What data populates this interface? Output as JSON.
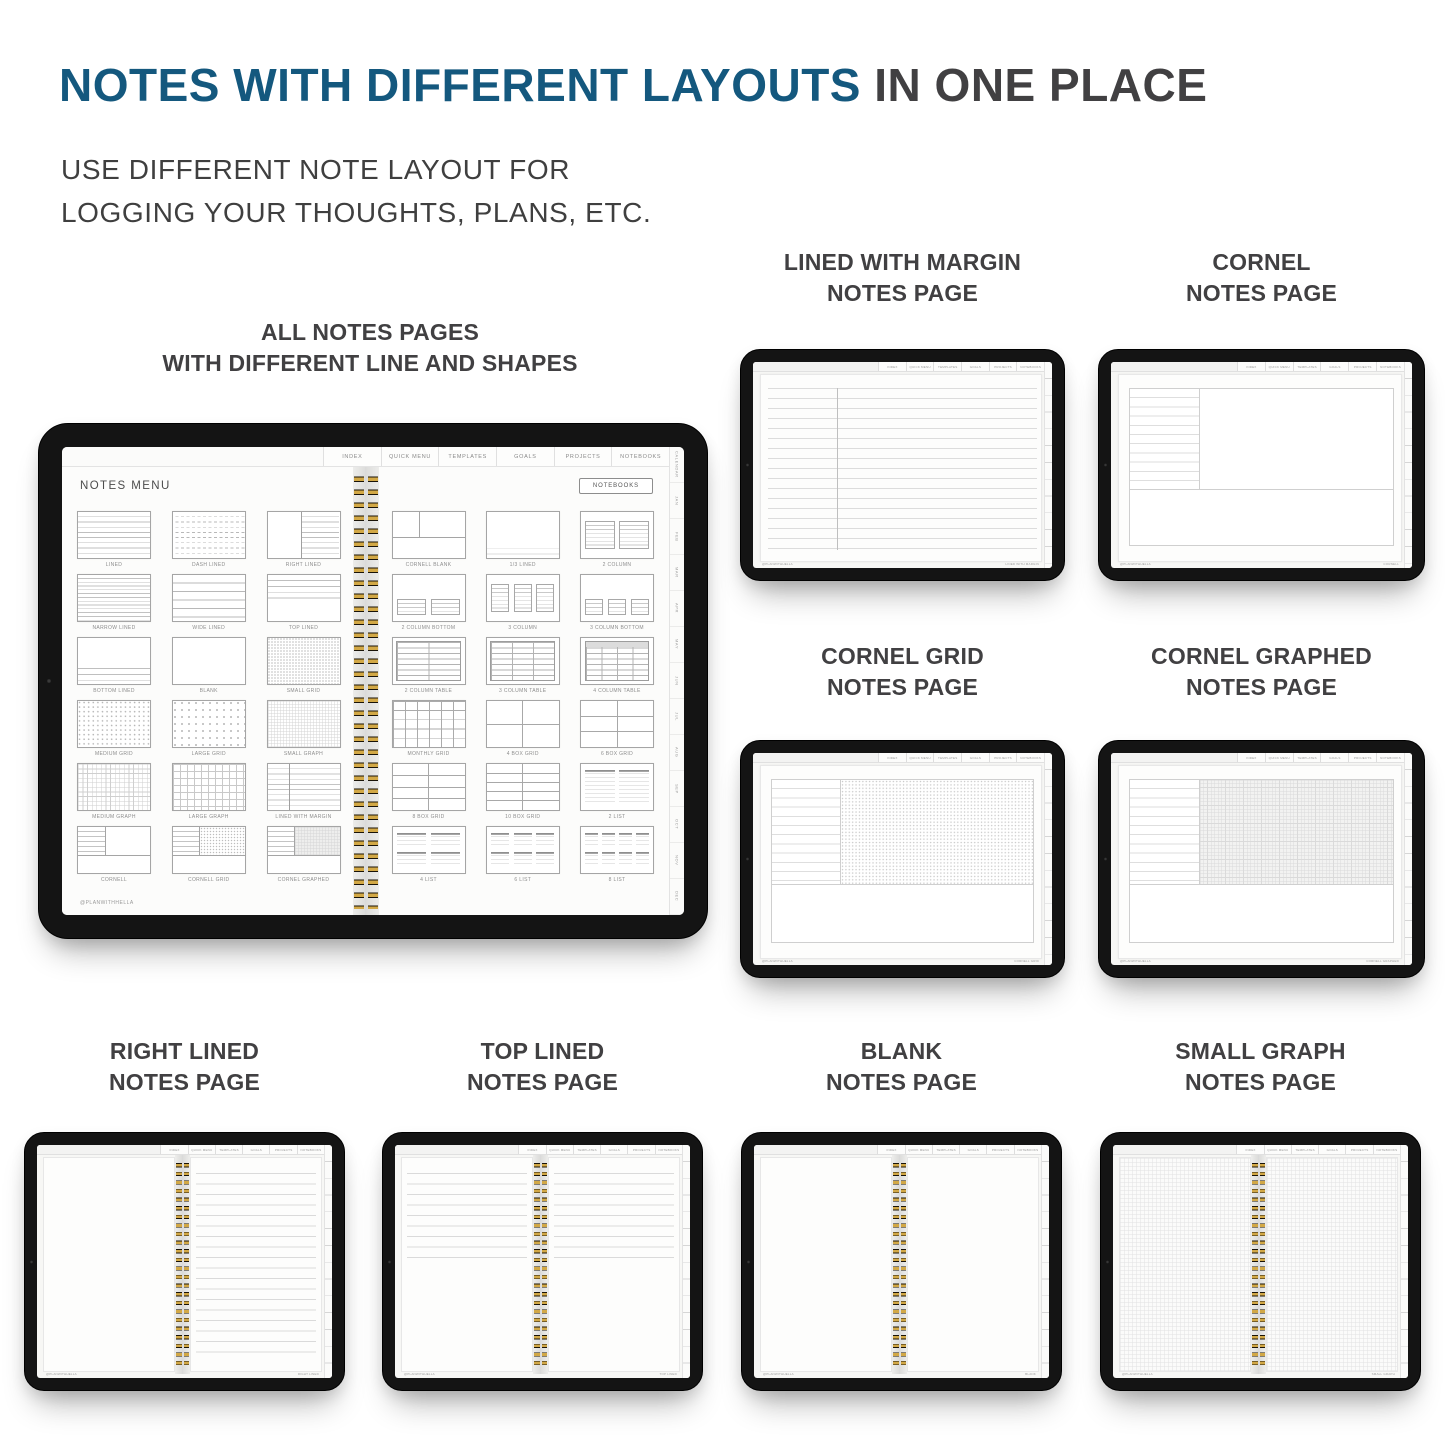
{
  "page": {
    "title_highlight": "NOTES WITH DIFFERENT LAYOUTS",
    "title_rest": " IN ONE PLACE",
    "subtitle_line1": "USE DIFFERENT NOTE LAYOUT FOR",
    "subtitle_line2": "LOGGING YOUR THOUGHTS, PLANS, ETC.",
    "colors": {
      "accent_blue": "#14587E",
      "heading_gray": "#414042",
      "spiral_gold": "#D2A846"
    }
  },
  "main_tablet": {
    "caption_line1": "ALL NOTES PAGES",
    "caption_line2": "WITH DIFFERENT LINE AND SHAPES",
    "screen": {
      "tabs": [
        "INDEX",
        "QUICK MENU",
        "TEMPLATES",
        "GOALS",
        "PROJECTS",
        "NOTEBOOKS"
      ],
      "side_tabs": [
        "CALENDAR",
        "JAN",
        "FEB",
        "MAR",
        "APR",
        "MAY",
        "JUN",
        "JUL",
        "AUG",
        "SEP",
        "OCT",
        "NOV",
        "DEC"
      ],
      "notes_menu_title": "NOTES MENU",
      "notebooks_button": "NOTEBOOKS",
      "footer_handle": "@PLANWITHHELLA",
      "left_page_items": [
        {
          "label": "LINED",
          "pattern": "lined"
        },
        {
          "label": "DASH LINED",
          "pattern": "dash-lined"
        },
        {
          "label": "RIGHT LINED",
          "pattern": "right-lined"
        },
        {
          "label": "NARROW LINED",
          "pattern": "narrow-lined"
        },
        {
          "label": "WIDE LINED",
          "pattern": "wide-lined"
        },
        {
          "label": "TOP LINED",
          "pattern": "top-lined"
        },
        {
          "label": "BOTTOM LINED",
          "pattern": "bottom-lined"
        },
        {
          "label": "BLANK",
          "pattern": "blank"
        },
        {
          "label": "SMALL GRID",
          "pattern": "small-grid"
        },
        {
          "label": "MEDIUM GRID",
          "pattern": "medium-grid"
        },
        {
          "label": "LARGE GRID",
          "pattern": "large-grid"
        },
        {
          "label": "SMALL GRAPH",
          "pattern": "small-graph"
        },
        {
          "label": "MEDIUM GRAPH",
          "pattern": "medium-graph"
        },
        {
          "label": "LARGE GRAPH",
          "pattern": "large-graph"
        },
        {
          "label": "LINED WITH MARGIN",
          "pattern": "lined-margin"
        },
        {
          "label": "CORNELL",
          "pattern": "cornell"
        },
        {
          "label": "CORNELL GRID",
          "pattern": "cornell-grid"
        },
        {
          "label": "CORNEL GRAPHED",
          "pattern": "cornell-graphed"
        }
      ],
      "right_page_items": [
        {
          "label": "CORNELL BLANK",
          "pattern": "cornell-blank"
        },
        {
          "label": "1/3 LINED",
          "pattern": "one-third-lined"
        },
        {
          "label": "2 COLUMN",
          "pattern": "col-2"
        },
        {
          "label": "2 COLUMN BOTTOM",
          "pattern": "col-2-bottom"
        },
        {
          "label": "3 COLUMN",
          "pattern": "col-3"
        },
        {
          "label": "3 COLUMN BOTTOM",
          "pattern": "col-3-bottom"
        },
        {
          "label": "2 COLUMN TABLE",
          "pattern": "table-2"
        },
        {
          "label": "3 COLUMN TABLE",
          "pattern": "table-3"
        },
        {
          "label": "4 COLUMN TABLE",
          "pattern": "table-4"
        },
        {
          "label": "MONTHLY GRID",
          "pattern": "monthly-grid"
        },
        {
          "label": "4 BOX GRID",
          "pattern": "box-4"
        },
        {
          "label": "6 BOX GRID",
          "pattern": "box-6"
        },
        {
          "label": "8 BOX GRID",
          "pattern": "box-8"
        },
        {
          "label": "10 BOX GRID",
          "pattern": "box-10"
        },
        {
          "label": "2 LIST",
          "pattern": "list-2"
        },
        {
          "label": "4 LIST",
          "pattern": "list-4"
        },
        {
          "label": "6 LIST",
          "pattern": "list-6"
        },
        {
          "label": "8 LIST",
          "pattern": "list-8"
        }
      ]
    }
  },
  "mini_tabs": [
    "INDEX",
    "QUICK MENU",
    "TEMPLATES",
    "GOALS",
    "PROJECTS",
    "NOTEBOOKS"
  ],
  "cards": [
    {
      "title_line1": "LINED WITH MARGIN",
      "title_line2": "NOTES PAGE",
      "layout": "lined-margin-page",
      "footer_left": "@PLANWITHHELLA",
      "footer_right": "LINED WITH MARGIN"
    },
    {
      "title_line1": "CORNEL",
      "title_line2": "NOTES PAGE",
      "layout": "cornell-page",
      "footer_left": "@PLANWITHHELLA",
      "footer_right": "CORNELL"
    },
    {
      "title_line1": "CORNEL GRID",
      "title_line2": "NOTES PAGE",
      "layout": "cornell-grid-page",
      "footer_left": "@PLANWITHHELLA",
      "footer_right": "CORNELL GRID"
    },
    {
      "title_line1": "CORNEL GRAPHED",
      "title_line2": "NOTES PAGE",
      "layout": "cornell-graphed-page",
      "footer_left": "@PLANWITHHELLA",
      "footer_right": "CORNELL GRAPHED"
    },
    {
      "title_line1": "RIGHT LINED",
      "title_line2": "NOTES PAGE",
      "layout": "right-lined-spread",
      "footer_left": "@PLANWITHHELLA",
      "footer_right": "RIGHT LINED"
    },
    {
      "title_line1": "TOP LINED",
      "title_line2": "NOTES PAGE",
      "layout": "top-lined-spread",
      "footer_left": "@PLANWITHHELLA",
      "footer_right": "TOP LINED"
    },
    {
      "title_line1": "BLANK",
      "title_line2": "NOTES PAGE",
      "layout": "blank-spread",
      "footer_left": "@PLANWITHHELLA",
      "footer_right": "BLANK"
    },
    {
      "title_line1": "SMALL GRAPH",
      "title_line2": "NOTES PAGE",
      "layout": "small-graph-spread",
      "footer_left": "@PLANWITHHELLA",
      "footer_right": "SMALL GRAPH"
    }
  ]
}
